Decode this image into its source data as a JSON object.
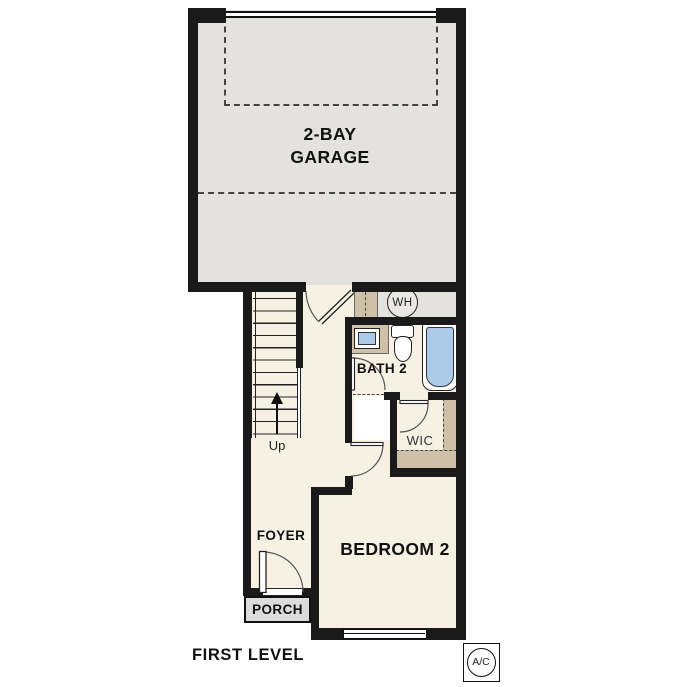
{
  "plan": {
    "title": "FIRST LEVEL",
    "rooms": {
      "garage": {
        "line1": "2-BAY",
        "line2": "GARAGE"
      },
      "bath": "BATH 2",
      "wic": "WIC",
      "foyer": "FOYER",
      "porch": "PORCH",
      "bedroom": "BEDROOM 2"
    },
    "annotations": {
      "water_heater": "WH",
      "stairs_direction": "Up",
      "ac_unit": "A/C"
    },
    "colors": {
      "wall": "#1a1a1a",
      "garage_floor": "#e3e2de",
      "room_floor": "#f7f1e4",
      "casework_tan": "#cfc1a7",
      "fixture_blue": "#abcbe9",
      "porch_floor": "#dcdcdc"
    }
  }
}
